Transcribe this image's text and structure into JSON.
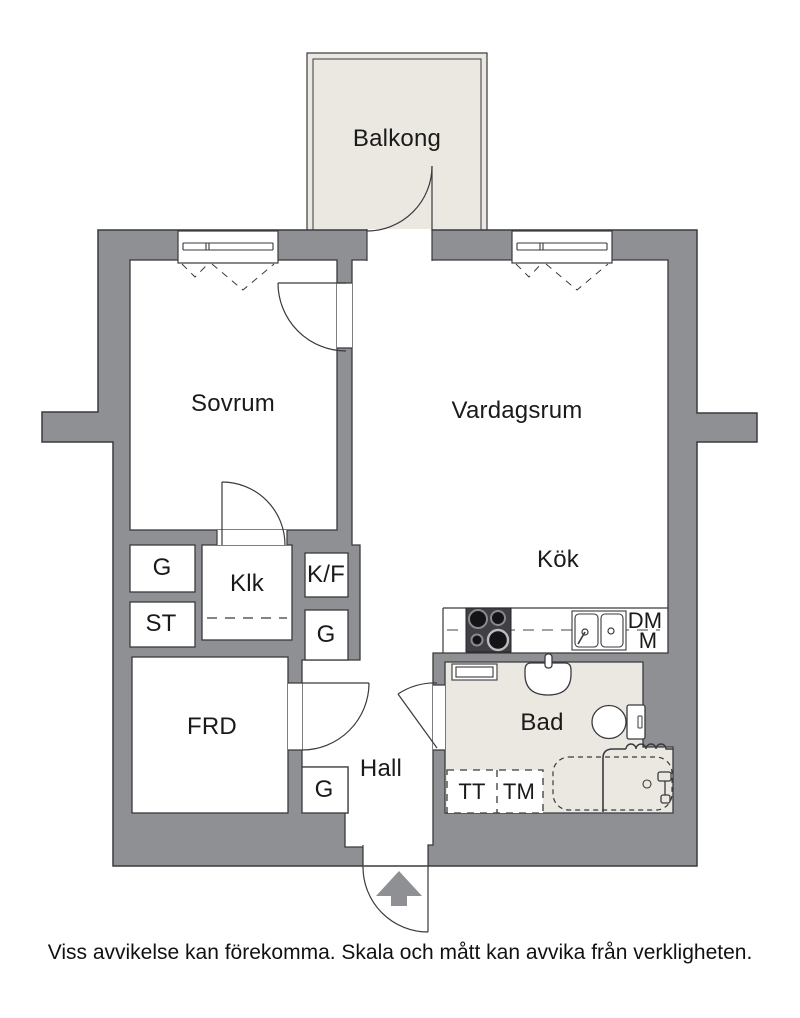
{
  "plan": {
    "type": "apartment-floor-plan",
    "colors": {
      "wall_fill": "#8F9093",
      "wall_outline": "#3A3A3E",
      "room_floor": "#FFFFFF",
      "balcony_floor": "#EBE8E2",
      "appliance_dark": "#3F3F44",
      "text": "#1A1A1A"
    },
    "rooms": {
      "balcony": "Balkong",
      "bedroom": "Sovrum",
      "living": "Vardagsrum",
      "kitchen": "Kök",
      "walk_in_closet": "Klk",
      "fridge_freezer": "K/F",
      "wardrobe": "G",
      "cleaning_closet": "ST",
      "storage": "FRD",
      "hall": "Hall",
      "bathroom": "Bad",
      "tumble_dryer": "TT",
      "washing_machine": "TM",
      "dishwasher": "DM",
      "micro": "M"
    },
    "footer": {
      "disclaimer": "Viss avvikelse kan förekomma. Skala och mått kan avvika från verkligheten."
    }
  }
}
